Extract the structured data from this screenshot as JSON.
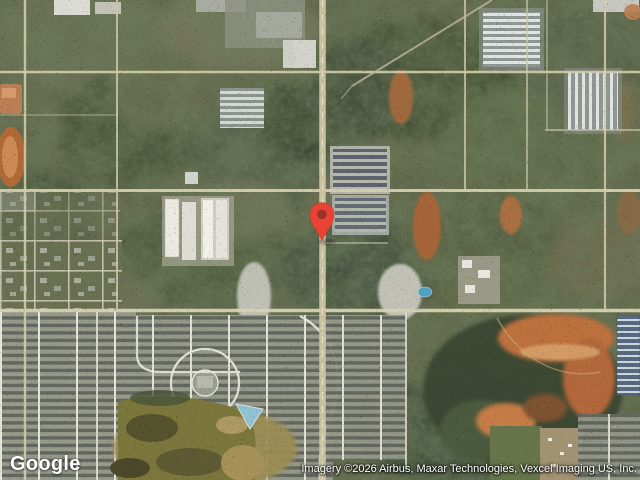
{
  "map": {
    "view_type": "satellite",
    "logo_text": "Google",
    "attribution_text": "Imagery ©2026 Airbus, Maxar Technologies, Vexcel Imaging US, Inc.",
    "marker": {
      "color": "#EA4335",
      "dot_color": "#9A3328",
      "position_px": {
        "x": 322,
        "y": 240
      }
    },
    "scene": {
      "description": "suburban satellite view: road grid, wooded lots, warehouses, dense subdivisions, murky retention pond, blue pond, orange cleared-dirt excavation",
      "water_color": "#8FC3D4",
      "murky_pond_color": "#7B773C",
      "dirt_color": "#BD713E",
      "road_color": "#D6CFAE"
    }
  }
}
